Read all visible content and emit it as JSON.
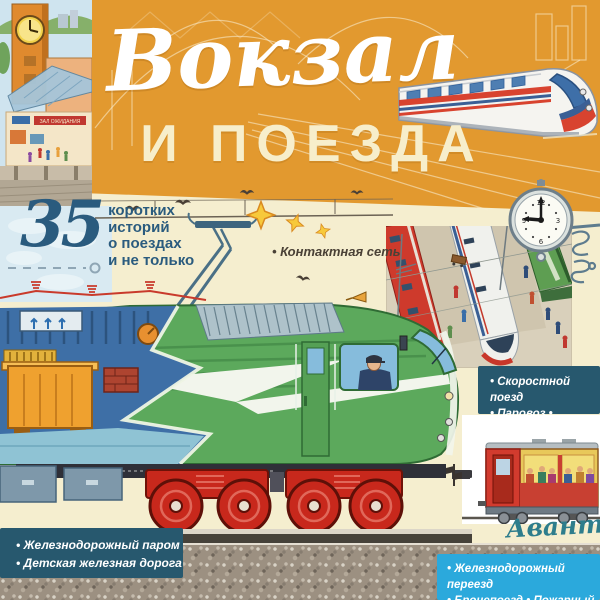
{
  "cover": {
    "title": {
      "line1": "Вокзал",
      "line2": "И ПОЕЗДА"
    },
    "badge": {
      "number": "35",
      "lines": [
        "коротких",
        "историй",
        "о поездах",
        "и не только"
      ]
    },
    "callouts": {
      "catenary": "• Контактная сеть"
    },
    "panels": {
      "speed": {
        "line1": "• Скоростной поезд",
        "line2": "• Паровоз • Трамвай"
      },
      "ferry": {
        "line1": "• Железнодорожный паром",
        "line2": "• Детская железная дорога"
      },
      "crossing": {
        "line1": "• Железнодорожный переезд",
        "line2": "• Бронепоезд • Пожарный поезд"
      }
    },
    "publisher": "Аванта",
    "station_sign": "ЗАЛ ОЖИДАНИЯ",
    "clock": {
      "time": "9:00",
      "numerals": [
        "12",
        "3",
        "6",
        "9"
      ]
    },
    "colors": {
      "orange": "#E2992F",
      "cream": "#F5EECF",
      "panel_teal": "#27586E",
      "panel_blue": "#2BA9DC",
      "loco_green": "#5CA95C",
      "bogie_red": "#C8281C",
      "title_white": "#FFFFFF",
      "title_cream": "#F7EECB",
      "badge_blue": "#2A5B7E"
    }
  }
}
